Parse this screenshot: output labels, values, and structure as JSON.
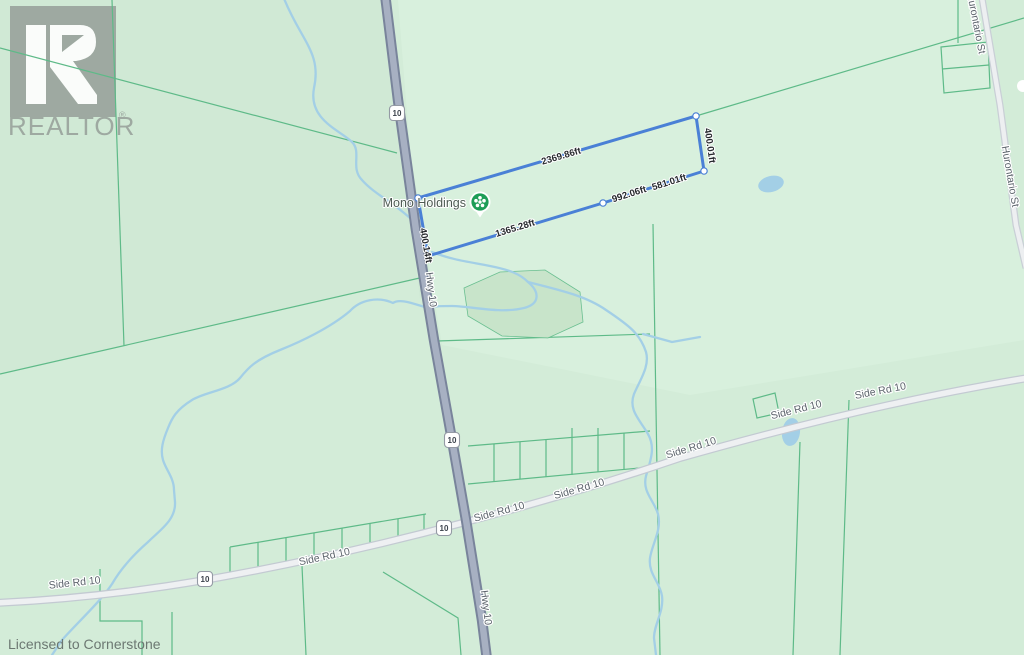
{
  "map": {
    "watermark": {
      "logo_text": "REALTOR",
      "registered_mark": "®"
    },
    "attribution": "Licensed to Cornerstone",
    "poi": {
      "name": "Mono Holdings"
    },
    "parcel": {
      "outline_color": "#4a80d6",
      "measurements": {
        "north": "2369.86ft",
        "east": "400.01ft",
        "west": "400.14ft",
        "south_west": "1365.28ft",
        "south_mid": "992.06ft",
        "south_east": "581.01ft"
      }
    },
    "roads": {
      "highway": {
        "name": "Hwy 10",
        "shield_number": "10"
      },
      "side_road": {
        "name": "Side Rd 10"
      },
      "arterial": {
        "name": "Hurontario St"
      }
    },
    "colors": {
      "land": "#d3ecd8",
      "parcel_lines": "#5eba88",
      "water": "#a3cfe6",
      "highway_fill": "#a7b0c2",
      "minor_road_fill": "#eef0f2",
      "poi_green": "#1d9d57",
      "watermark_gray": "#99a39c"
    }
  }
}
